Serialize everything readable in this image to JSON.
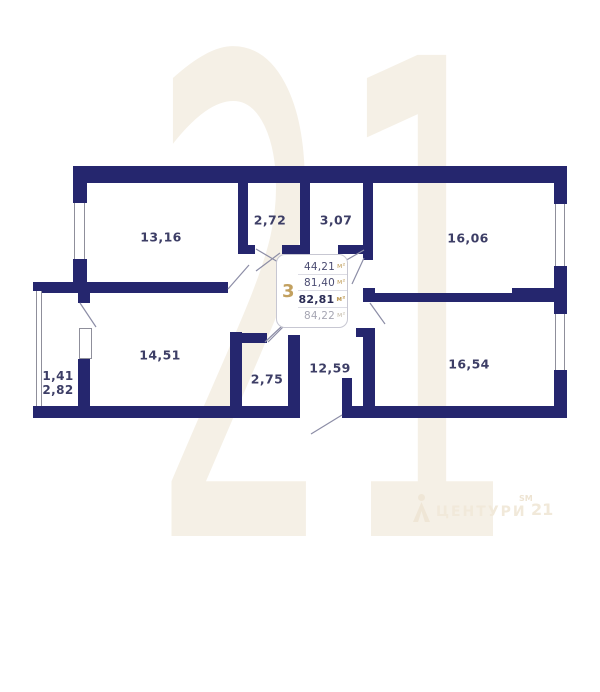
{
  "watermark": {
    "digits": "21",
    "brand_wordmark": "ЦЕНТУРИ",
    "brand_block": "21",
    "brand_sm": "SM"
  },
  "plan": {
    "rooms": [
      {
        "id": "room-13-16",
        "area": "13,16"
      },
      {
        "id": "room-2-72",
        "area": "2,72"
      },
      {
        "id": "room-3-07",
        "area": "3,07"
      },
      {
        "id": "room-16-06",
        "area": "16,06"
      },
      {
        "id": "room-14-51",
        "area": "14,51"
      },
      {
        "id": "room-2-75",
        "area": "2,75"
      },
      {
        "id": "room-12-59",
        "area": "12,59"
      },
      {
        "id": "room-16-54",
        "area": "16,54"
      },
      {
        "id": "balcony",
        "area_reduced": "1,41",
        "area_full": "2,82"
      }
    ]
  },
  "info_box": {
    "rooms_count": "3",
    "rows": [
      {
        "value": "44,21",
        "unit": "м²",
        "style": "normal"
      },
      {
        "value": "81,40",
        "unit": "м²",
        "style": "normal"
      },
      {
        "value": "82,81",
        "unit": "м²",
        "style": "bold"
      },
      {
        "value": "84,22",
        "unit": "м²",
        "style": "muted"
      }
    ]
  },
  "colors": {
    "wall": "#25266e",
    "accent_gold": "#c2a05f",
    "label": "#3d3e66",
    "watermark": "#f5f0e6"
  }
}
